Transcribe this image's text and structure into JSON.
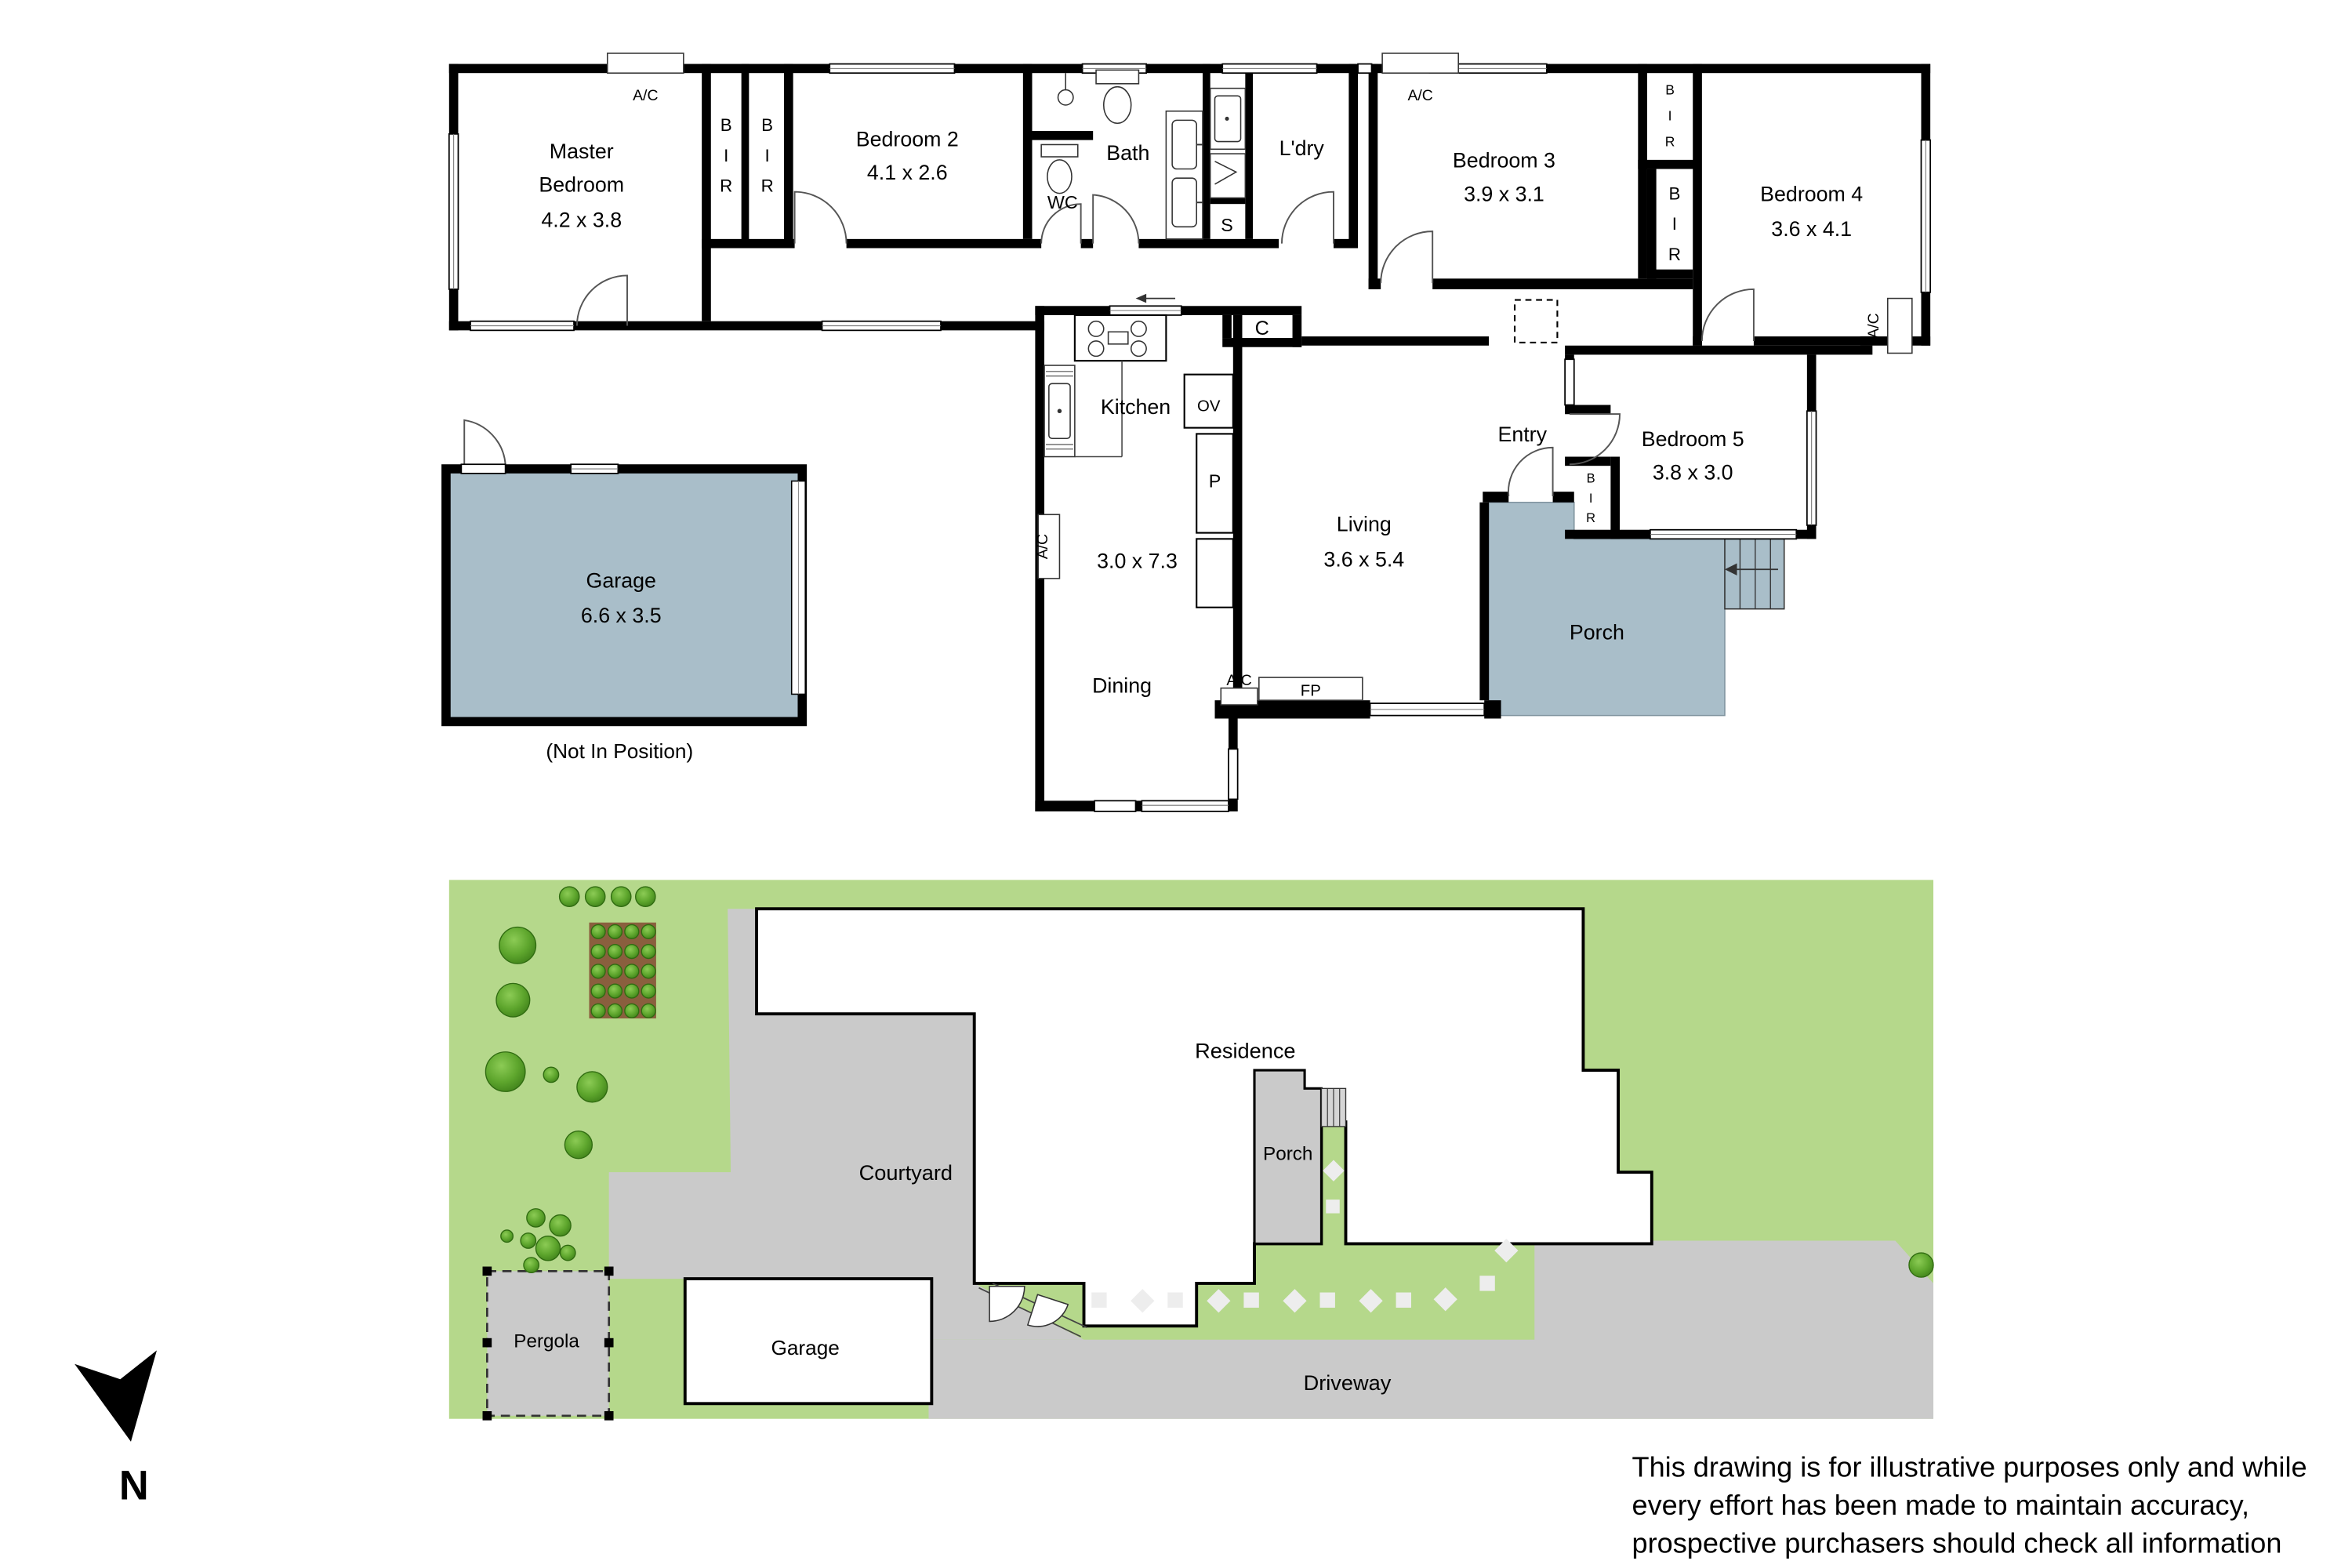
{
  "floorplan": {
    "rooms": {
      "master": {
        "line1": "Master",
        "line2": "Bedroom",
        "dim": "4.2 x 3.8"
      },
      "bedroom2": {
        "name": "Bedroom 2",
        "dim": "4.1 x 2.6"
      },
      "bedroom3": {
        "name": "Bedroom 3",
        "dim": "3.9 x 3.1"
      },
      "bedroom4": {
        "name": "Bedroom 4",
        "dim": "3.6 x 4.1"
      },
      "bedroom5": {
        "name": "Bedroom 5",
        "dim": "3.8 x 3.0"
      },
      "kitchen": {
        "name": "Kitchen",
        "dim": "3.0 x 7.3"
      },
      "living": {
        "name": "Living",
        "dim": "3.6 x 5.4"
      },
      "dining": {
        "name": "Dining"
      },
      "entry": {
        "name": "Entry"
      },
      "bath": {
        "name": "Bath"
      },
      "wc": {
        "name": "WC"
      },
      "laundry": {
        "name": "L'dry"
      },
      "porch": {
        "name": "Porch"
      },
      "garage": {
        "name": "Garage",
        "dim": "6.6 x 3.5",
        "note": "(Not In Position)"
      }
    },
    "tags": {
      "ac": "A/C",
      "bir_b": "B",
      "bir_i": "I",
      "bir_r": "R",
      "store": "S",
      "cupboard": "C",
      "oven": "OV",
      "pantry": "P",
      "fireplace": "FP"
    }
  },
  "siteplan": {
    "residence": "Residence",
    "courtyard": "Courtyard",
    "porch": "Porch",
    "garage": "Garage",
    "pergola": "Pergola",
    "driveway": "Driveway"
  },
  "compass": {
    "north": "N"
  },
  "disclaimer": {
    "line1": "This drawing is for illustrative purposes only and while",
    "line2": "every effort has been made to maintain accuracy,",
    "line3": "prospective purchasers should check all information"
  },
  "colors": {
    "wall": "#000000",
    "unit_fill": "#a9bec9",
    "lawn": "#b5d88b",
    "paving": "#cacaca",
    "tree_light": "#7cc247",
    "tree_dark": "#3f8417"
  }
}
